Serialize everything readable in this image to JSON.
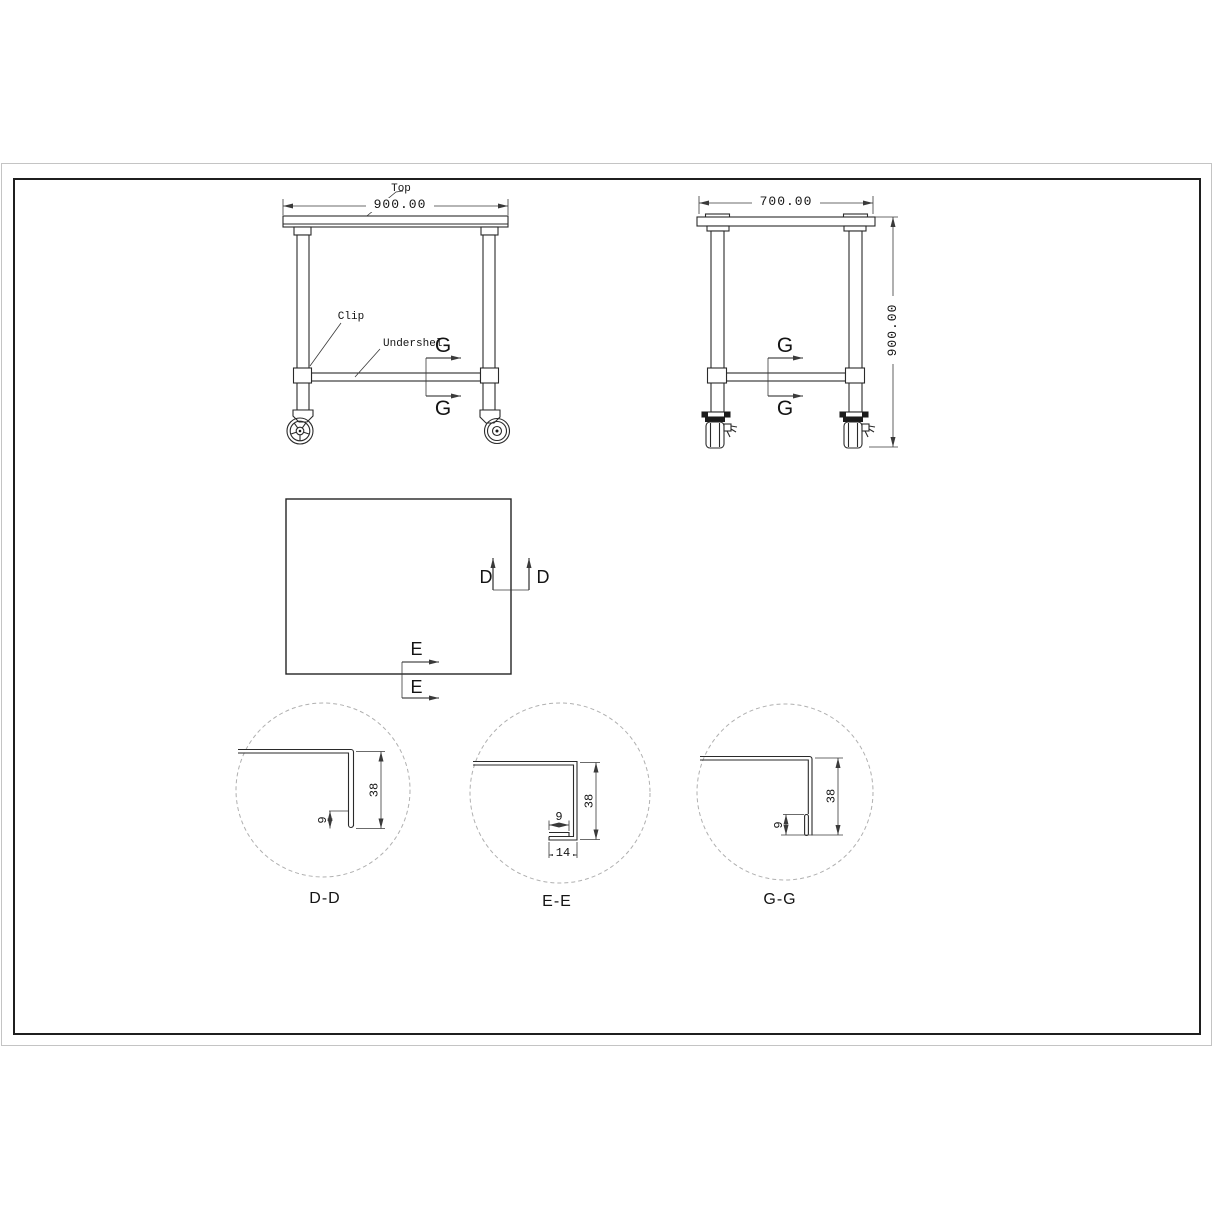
{
  "colors": {
    "line": "#2a2a2a",
    "dim": "#3a3a3a",
    "detail_circle": "#b0b0b0",
    "frame": "#1f1f1f",
    "page_edge": "#c4c4c4"
  },
  "front_view": {
    "top_label": "Top",
    "width_dim": "900.00",
    "clip_label": "Clip",
    "undershelf_label": "Undershel",
    "section_top": "G",
    "section_bottom": "G"
  },
  "side_view": {
    "width_dim": "700.00",
    "height_dim": "900.00",
    "section_top": "G",
    "section_bottom": "G"
  },
  "plan_view": {
    "d_left": "D",
    "d_right": "D",
    "e_top": "E",
    "e_bottom": "E"
  },
  "details": {
    "dd": {
      "label": "D-D",
      "height": "38",
      "hem": "9"
    },
    "ee": {
      "label": "E-E",
      "height": "38",
      "hem": "9",
      "return_width": "14"
    },
    "gg": {
      "label": "G-G",
      "height": "38",
      "hem": "9"
    }
  }
}
